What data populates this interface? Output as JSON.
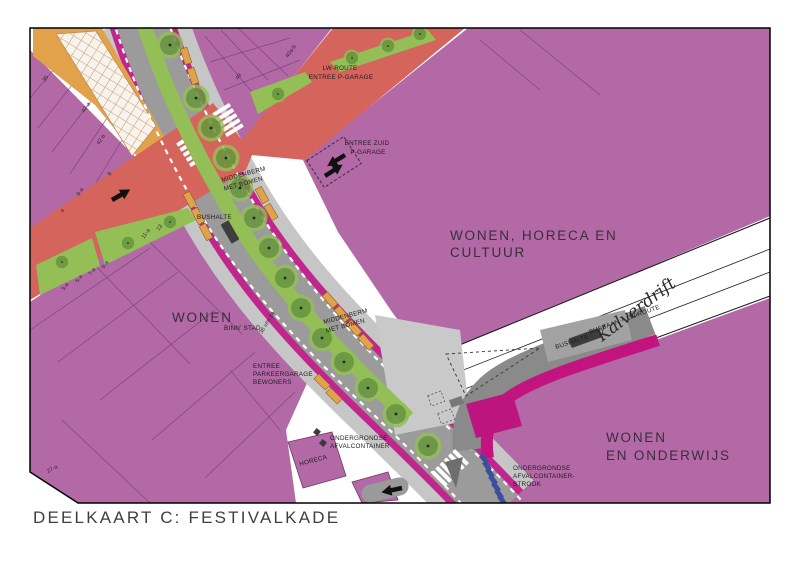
{
  "palette": {
    "purple": "#b269a6",
    "purpleLine": "#6f3a68",
    "red": "#d4645c",
    "roadGray": "#9b9b9b",
    "sideGray": "#c6c6c6",
    "plazaGray": "#c9c9c9",
    "busGray": "#8a8a8a",
    "platformGray": "#a2a2a2",
    "magenta": "#c0268c",
    "magentaDark": "#c2137f",
    "treeLight": "#93bf56",
    "treeDark": "#3f6e28",
    "orange": "#e2a24c",
    "hatch": "#cf9a6a",
    "blue": "#3c4e9e",
    "shelter": "#3d3d3d",
    "ink": "#1f1c20",
    "frame": "#000000"
  },
  "title": "DEELKAART C: FESTIVALKADE",
  "zones": {
    "wonen": "WONEN",
    "horeca_l1": "WONEN, HORECA EN",
    "horeca_l2": "CULTUUR",
    "onderwijs_l1": "WONEN",
    "onderwijs_l2": "EN ONDERWIJS"
  },
  "street": {
    "name": "Kalverdrift",
    "busbaan": "BUSBAAN + LW-ROUTE"
  },
  "labels": {
    "lw_route_l1": "LW-ROUTE",
    "lw_route_l2": "ENTREE P-GARAGE",
    "entree_zuid_l1": "ENTREE ZUID",
    "entree_zuid_l2": "P-GARAGE",
    "middenberm_l1": "MIDDENBERM",
    "middenberm_l2": "MET BOMEN",
    "bushalte": "BUSHALTE",
    "binnenstad": "BINN' STAD",
    "entree_parkeer_l1": "ENTREE",
    "entree_parkeer_l2": "PARKEERGARAGE",
    "entree_parkeer_l3": "BEWONERS",
    "afval_l1": "ONDERGRONDSE",
    "afval_l2": "AFVALCONTAINER",
    "strook_l1": "ONDERGRONDSE",
    "strook_l2": "AFVALCONTAINER-",
    "strook_l3": "STROOK",
    "horeca": "HORECA"
  },
  "house_numbers": [
    "3-a",
    "5-a",
    "7-a",
    "9-a",
    "11-a",
    "13",
    "4",
    "6-a",
    "8",
    "35",
    "42-a",
    "42-b",
    "40a-b",
    "49",
    "27-a",
    "38 v/m 34"
  ]
}
